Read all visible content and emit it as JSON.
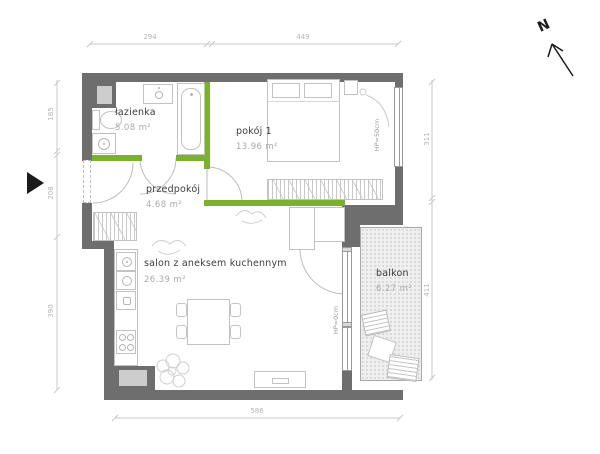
{
  "plan_title": "apartment-floor-plan",
  "compass": {
    "north": "N"
  },
  "rooms": {
    "lazienka": {
      "name": "łazienka",
      "area": "5.08  m²"
    },
    "pokoj1": {
      "name": "pokój 1",
      "area": "13.96  m²"
    },
    "przedpokoj": {
      "name": "przedpokój",
      "area": "4.68  m²"
    },
    "salon": {
      "name": "salon z aneksem kuchennym",
      "area": "26.39 m²"
    },
    "balkon": {
      "name": "balkon",
      "area": "6.27  m²"
    }
  },
  "window_sills": {
    "pokoj1_sill": "HP=50cm",
    "balkon_sill": "HP=0cm"
  },
  "dimensions": {
    "top": [
      "294",
      "449"
    ],
    "left": [
      "185",
      "208",
      "390"
    ],
    "right": [
      "311",
      "411"
    ],
    "bottom": [
      "586"
    ]
  },
  "colors": {
    "wall": "#6e6e6e",
    "partition_green": "#7ab32a",
    "balcony_fill": "#efefef"
  }
}
